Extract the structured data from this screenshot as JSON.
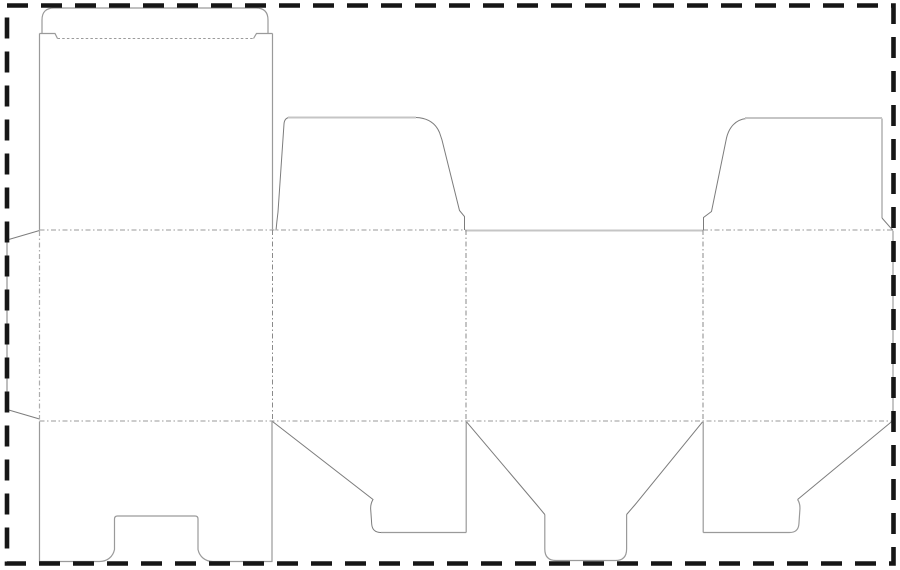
{
  "app": {
    "type": "packaging-dieline-template",
    "description": "Die-cut folding box template (dieline): four body panels with top shoulder flaps, rounded tuck flap, glue flap, bottom flaps with tongue and thumb notch, surrounded by a dashed sheet border"
  },
  "canvas": {
    "width": 900,
    "height": 570,
    "background": "#ffffff"
  },
  "styles": {
    "border": {
      "stroke": "#161616",
      "width": 4.6,
      "dash": "21 13"
    },
    "cut-dark": {
      "stroke": "#7c7c7c",
      "width": 1,
      "dash": ""
    },
    "cut-med": {
      "stroke": "#9a9a9a",
      "width": 1.2,
      "dash": ""
    },
    "cut-light": {
      "stroke": "#c5c5c5",
      "width": 2,
      "dash": ""
    },
    "fold": {
      "stroke": "#adadad",
      "width": 1.2,
      "dash": "5 2.5 1.5 2.5"
    },
    "fold-dark": {
      "stroke": "#8a8a8a",
      "width": 1,
      "dash": "5 2.5 1.5 2.5"
    },
    "dotted": {
      "stroke": "#9b9b9b",
      "width": 1,
      "dash": "2.5 2.2"
    }
  },
  "dieline": {
    "paths": [
      {
        "name": "panel4-right-edge",
        "style": "cut-light",
        "d": "M 893,231 V 420"
      },
      {
        "name": "tuck-flap-outline",
        "style": "cut-med",
        "d": "M 42,33.5 V 20 Q 42,8 54,8 H 256 Q 268,8 268,20 V 33.5"
      },
      {
        "name": "tuck-flap-left-shoulder",
        "style": "cut-med",
        "d": "M 39.5,33.5 H 55 L 57.5,38.5"
      },
      {
        "name": "tuck-flap-right-shoulder",
        "style": "cut-med",
        "d": "M 253.5,38.5 L 256.5,33.5 H 272.5"
      },
      {
        "name": "tuck-flap-fold",
        "style": "dotted",
        "d": "M 57.5,38.5 H 253.5"
      },
      {
        "name": "panel1-top-left-edge",
        "style": "cut-med",
        "d": "M 39.5,33.5 V 230"
      },
      {
        "name": "panel1-top-right-edge",
        "style": "cut-med",
        "d": "M 272.5,33.5 V 230"
      },
      {
        "name": "glue-flap-outline",
        "style": "cut-dark",
        "d": "M 39.5,230.5 L 7,240 V 409.5 L 39.5,419"
      },
      {
        "name": "glue-flap-crease",
        "style": "fold",
        "d": "M 39.5,231 V 419.5"
      },
      {
        "name": "top-fold-left",
        "style": "fold",
        "d": "M 39.5,230 H 466"
      },
      {
        "name": "panel3-top-cut",
        "style": "cut-light",
        "d": "M 465,230.5 H 703"
      },
      {
        "name": "top-fold-right",
        "style": "fold",
        "d": "M 703,230 H 893"
      },
      {
        "name": "bottom-fold",
        "style": "fold",
        "d": "M 39.5,421 H 893"
      },
      {
        "name": "crease-panel1-panel2",
        "style": "fold-dark",
        "d": "M 272.5,230 V 421"
      },
      {
        "name": "crease-panel2-panel3",
        "style": "fold-dark",
        "d": "M 466,230 V 421"
      },
      {
        "name": "crease-panel3-panel4",
        "style": "fold-dark",
        "d": "M 703,230 V 421"
      },
      {
        "name": "flap2-left-edge",
        "style": "cut-dark",
        "d": "M 276,230.5 C 276.5,225 277,220 278,212 L 284,124 Q 284.5,117.5 290,117.5"
      },
      {
        "name": "flap2-top-cut",
        "style": "cut-light",
        "d": "M 288,117.5 H 416"
      },
      {
        "name": "flap2-right-edge",
        "style": "cut-dark",
        "d": "M 416,117.5 C 428,118 435.5,123 439.5,132.5 L 442,140 L 459.5,210.5 L 464.5,216.5 V 230"
      },
      {
        "name": "flap4-left-edge",
        "style": "cut-dark",
        "d": "M 703.5,230 V 217.5 L 711.5,211.5 L 726.5,138 C 729,127.5 735.5,119.5 746.5,118.5"
      },
      {
        "name": "flap4-top-cut",
        "style": "cut-light",
        "d": "M 745,118 H 882"
      },
      {
        "name": "flap4-right-edge",
        "style": "cut-light",
        "d": "M 882,118.5 V 218"
      },
      {
        "name": "flap4-right-notch",
        "style": "cut-dark",
        "d": "M 882,218 L 893,230.5"
      },
      {
        "name": "panel1-bottom-outline",
        "style": "cut-med",
        "d": "M 39.5,421.5 V 561.5 H 99.5 C 107.5,561.5 113,556.5 114.5,549.5 V 519 Q 114.5,516 117.5,516 H 195 Q 198,516 198,519 V 549.5 C 199.5,556.5 205,561.5 213,561.5 H 272 V 421.5"
      },
      {
        "name": "flap2-bottom-left-diagonal",
        "style": "cut-dark",
        "d": "M 272.5,421.5 L 373,499.5 C 371.2,502.5 370.4,505.5 370.7,509.5 L 371.7,524 Q 372.3,532.5 381,532.5"
      },
      {
        "name": "flap2-bottom-cut",
        "style": "cut-med",
        "d": "M 381,532.5 H 466.2"
      },
      {
        "name": "flap2-bottom-right-edge",
        "style": "cut-med",
        "d": "M 466.2,532.5 V 421.8"
      },
      {
        "name": "flap3-bottom-left-diagonal",
        "style": "cut-dark",
        "d": "M 466.5,421.8 L 536.5,504.5 L 544.8,514.5"
      },
      {
        "name": "flap3-tongue",
        "style": "cut-med",
        "d": "M 544.8,514.5 V 549 Q 544.8,560.5 556,560.5 H 615.5 Q 626.6,560.5 626.6,549 V 514.5"
      },
      {
        "name": "flap3-bottom-right-diagonal",
        "style": "cut-dark",
        "d": "M 626.6,514.5 L 634.8,505 L 702.6,421.8"
      },
      {
        "name": "flap4-bottom-left-edge",
        "style": "cut-med",
        "d": "M 703.2,421.8 V 532.5"
      },
      {
        "name": "flap4-bottom-cut",
        "style": "cut-med",
        "d": "M 703.2,532.5 H 789.5"
      },
      {
        "name": "flap4-bottom-hook",
        "style": "cut-med",
        "d": "M 789.5,532.5 Q 798.3,532.5 798.9,524 L 799.9,509.5 C 800.2,505.5 799.6,502.5 797.6,499.5"
      },
      {
        "name": "flap4-bottom-right-diagonal",
        "style": "cut-dark",
        "d": "M 797.6,499.5 L 893,420.5"
      },
      {
        "name": "sheet-border",
        "style": "border",
        "d": "M 7,5.5 H 893.5 V 563.5 H 7 Z"
      }
    ]
  }
}
